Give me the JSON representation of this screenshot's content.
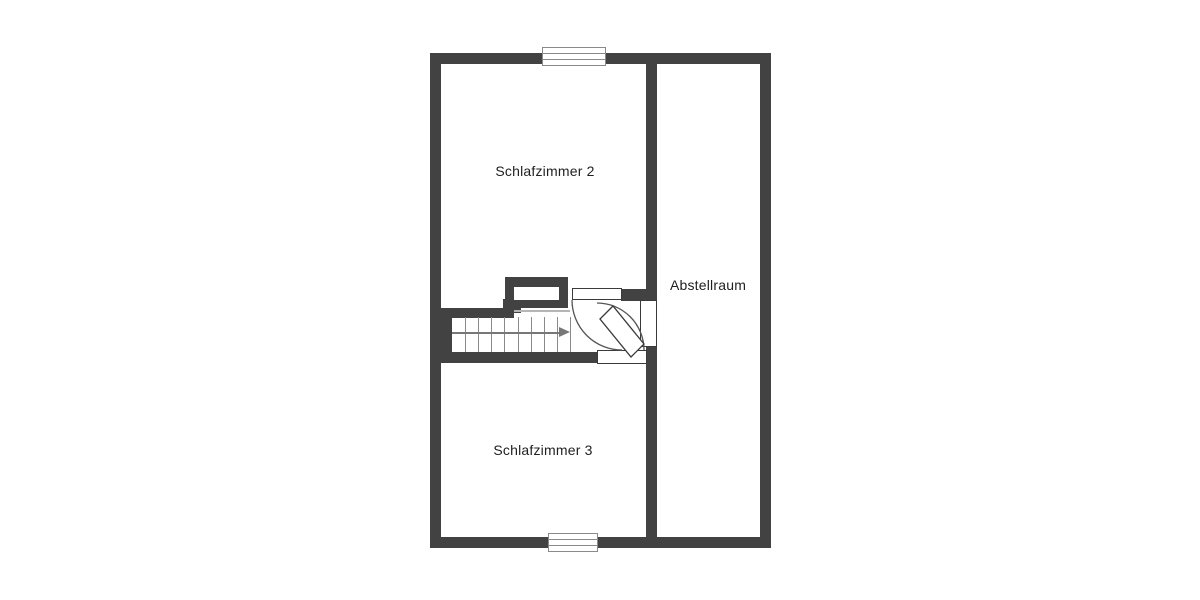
{
  "plan_title": "floor-plan-upper-storey",
  "rooms": {
    "bedroom2": {
      "label": "Schlafzimmer 2"
    },
    "storage": {
      "label": "Abstellraum"
    },
    "bedroom3": {
      "label": "Schlafzimmer 3"
    }
  },
  "stairs": {
    "tread_count": 9,
    "tread_spacing_px": 13.1,
    "direction_icon": "right-arrow"
  },
  "features": {
    "window_count": 2,
    "door_count": 3,
    "chimney_count": 1
  },
  "colors": {
    "wall": "#424242",
    "thin_line": "#8a8a8a",
    "arc": "#555555",
    "door_border": "#3a3a3a",
    "text": "#1f1f1f",
    "background": "#ffffff"
  }
}
